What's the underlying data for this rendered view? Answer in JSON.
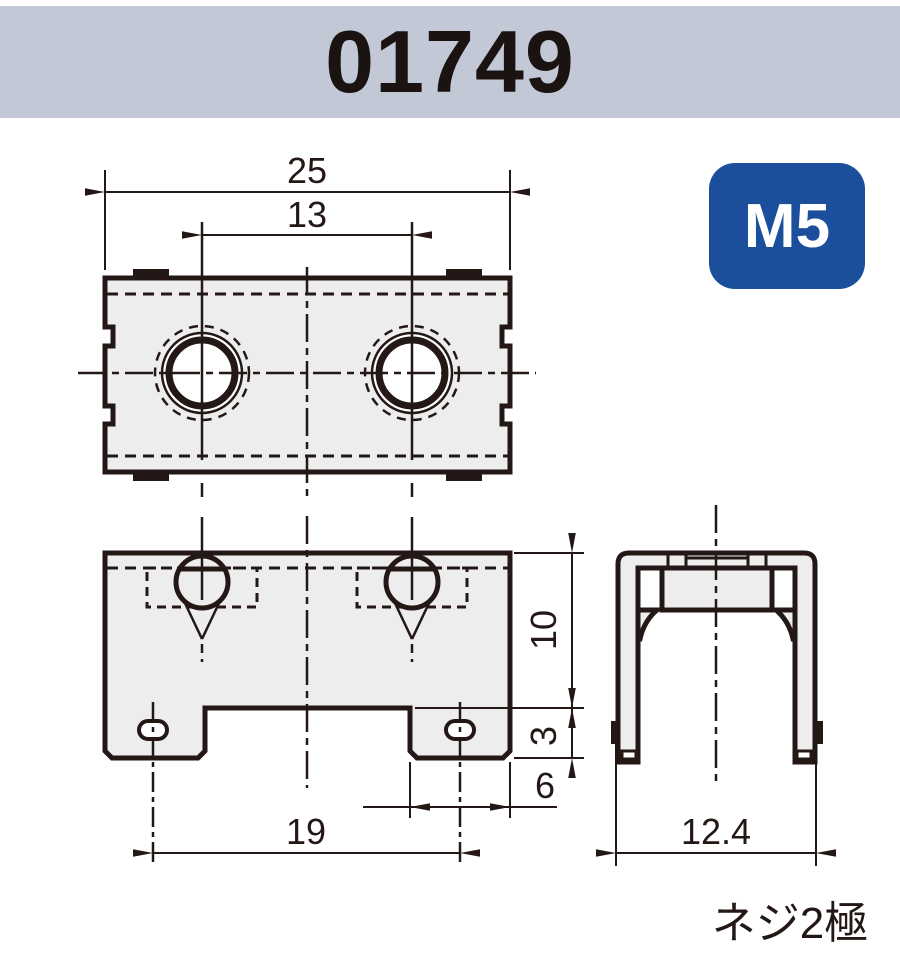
{
  "title": {
    "part_number": "01749"
  },
  "badge": {
    "label": "M5"
  },
  "caption": {
    "text": "ネジ2極"
  },
  "dimensions": {
    "total_width": "25",
    "hole_pitch": "13",
    "body_height": "10",
    "foot_height": "3",
    "foot_width": "6",
    "lead_pitch": "19",
    "side_width": "12.4"
  },
  "colors": {
    "header_bg": "#c3c8d6",
    "badge_bg": "#1b4f9c",
    "badge_text": "#ffffff",
    "line": "#231815",
    "body_fill": "#ededee",
    "background": "#ffffff"
  }
}
